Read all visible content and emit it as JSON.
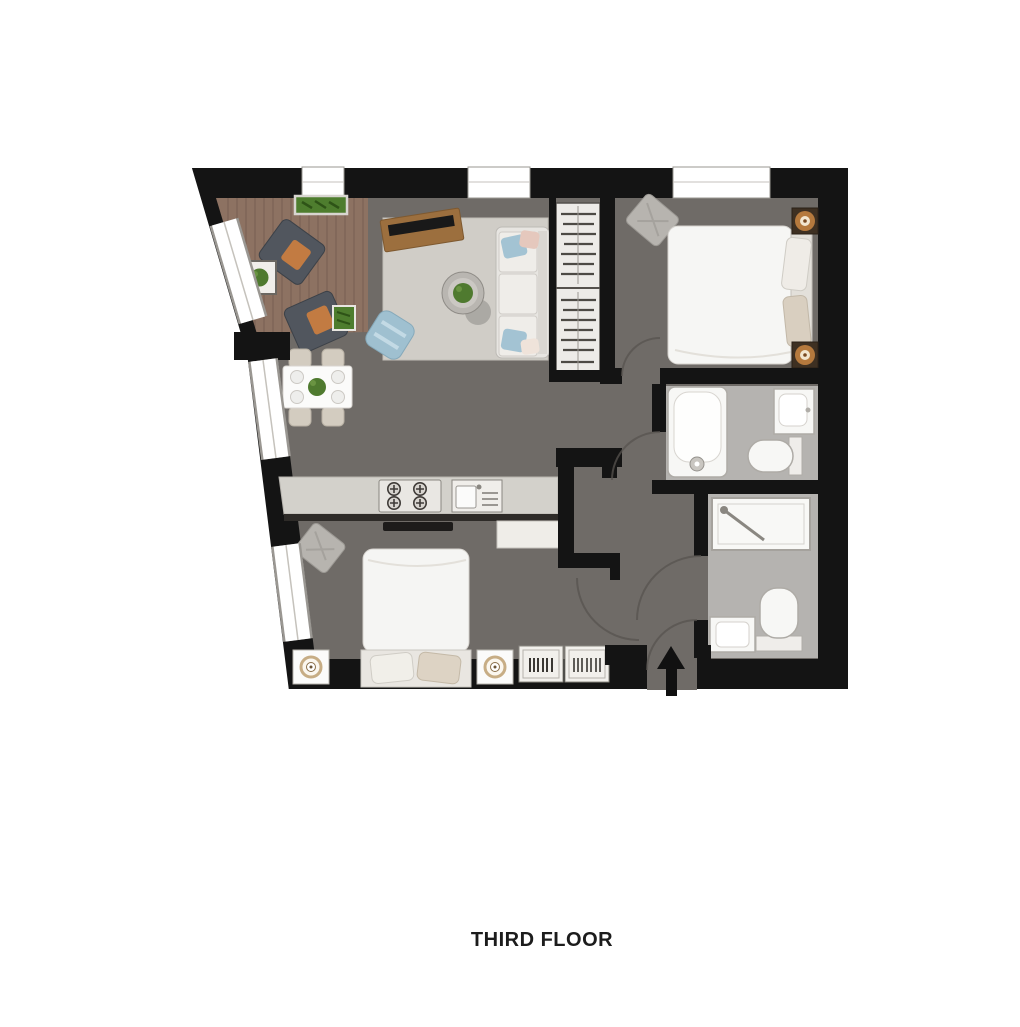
{
  "title": {
    "label": "THIRD FLOOR"
  },
  "plan": {
    "type": "apartment floor plan (top-down)",
    "features": [
      "balcony-terrace",
      "living-area",
      "dining-area",
      "kitchen",
      "wardrobe",
      "bedroom-1",
      "bathroom",
      "shower-room",
      "bedroom-2",
      "hallway",
      "entrance"
    ],
    "furniture": [
      "armchair",
      "side-table",
      "planter",
      "tv-unit",
      "tv",
      "sofa",
      "coffee-table",
      "pouf",
      "dining-table",
      "dining-chair",
      "hanging-rail",
      "double-bed",
      "bedside-table",
      "bedside-lamp",
      "bathtub",
      "washbasin",
      "toilet",
      "shower",
      "hob",
      "kitchen-sink",
      "dresser",
      "desk",
      "chair-cushion"
    ],
    "colors": {
      "wall": "#141414",
      "floor_dark": "#6f6b67",
      "deck": "#8d7262",
      "rug": "#d0cdc7",
      "counter": "#d3d1cb",
      "bath_floor": "#b5b3b0",
      "fixture_white": "#f7f7f5",
      "lamp_amber": "#b5793d",
      "cushion_orange": "#c27b42",
      "pouf_blue": "#9fc0d0",
      "plant_green": "#4f7a2f",
      "arc": "#57534f"
    }
  }
}
